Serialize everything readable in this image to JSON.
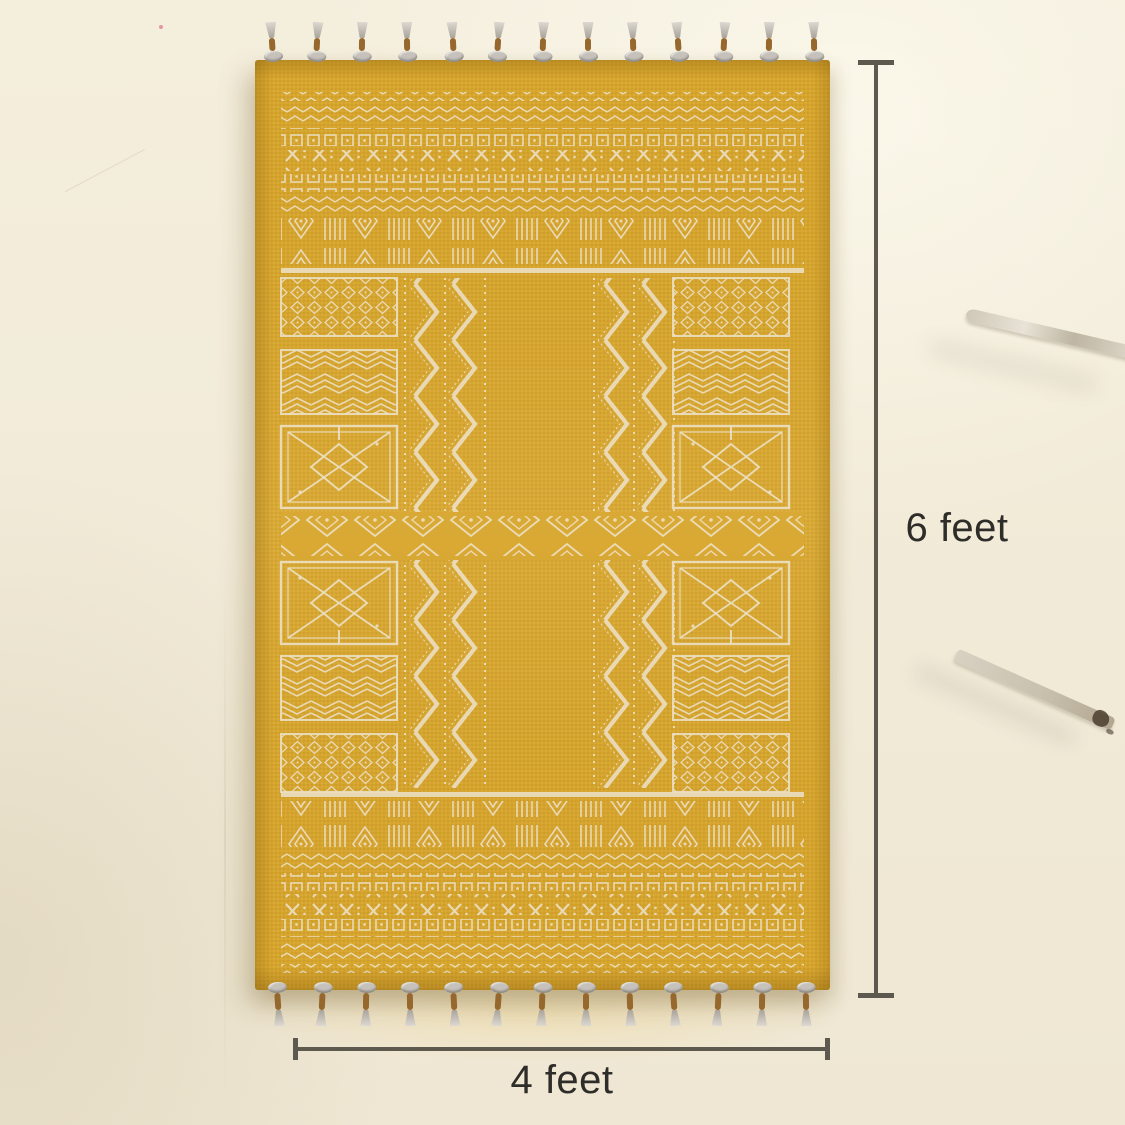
{
  "annotations": {
    "height": {
      "label": "6 feet"
    },
    "width": {
      "label": "4 feet"
    }
  },
  "rug": {
    "top_tassel_count": 13,
    "bottom_tassel_count": 13
  },
  "colors": {
    "backdrop": "#f1ebdb",
    "rug_base": "#d7a52c",
    "pattern_cream": "#ecdfc2",
    "dimension_line": "#5d594e",
    "label_text": "#2f2d29",
    "tassel_gray": "#c6c2bb",
    "tassel_brown": "#96682e",
    "stick_light": "#d9d3c5",
    "stick_dark": "#4b3e2f"
  }
}
